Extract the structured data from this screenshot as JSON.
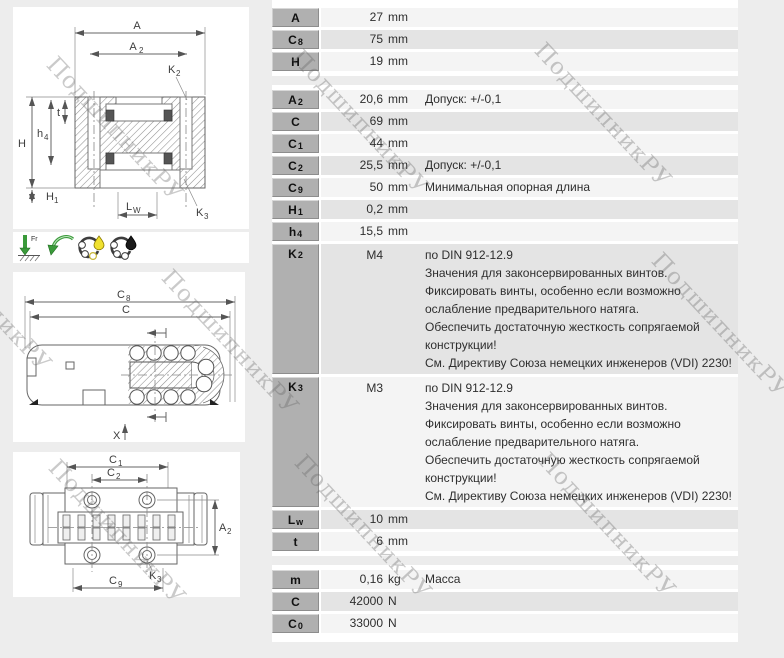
{
  "watermark": {
    "text": "ПодшипникРУ",
    "positions": [
      {
        "x": 60,
        "y": 52
      },
      {
        "x": 305,
        "y": 45
      },
      {
        "x": 548,
        "y": 38
      },
      {
        "x": -72,
        "y": 222
      },
      {
        "x": 175,
        "y": 265
      },
      {
        "x": 665,
        "y": 248
      },
      {
        "x": 62,
        "y": 455
      },
      {
        "x": 308,
        "y": 450
      },
      {
        "x": 552,
        "y": 448
      }
    ]
  },
  "colors": {
    "page_bg": "#ededed",
    "label_cell": "#b0b0b0",
    "row_light": "#f4f4f4",
    "row_dark": "#e4e4e4",
    "accent_green": "#3a9a3a",
    "drop_yellow": "#f0e130",
    "drop_black": "#1a1a1a"
  },
  "drawings": {
    "section_view": {
      "dim_A": "A",
      "dim_A2_base": "A",
      "dim_A2_sub": "2",
      "dim_K2_base": "K",
      "dim_K2_sub": "2",
      "dim_H": "H",
      "dim_h4_base": "h",
      "dim_h4_sub": "4",
      "dim_t": "t",
      "dim_H1_base": "H",
      "dim_H1_sub": "1",
      "dim_Lw_base": "L",
      "dim_Lw_sub": "W",
      "dim_K3_base": "K",
      "dim_K3_sub": "3"
    },
    "side_view": {
      "dim_C8_base": "C",
      "dim_C8_sub": "8",
      "dim_C": "C",
      "dim_X": "X"
    },
    "bottom_view": {
      "dim_C1_base": "C",
      "dim_C1_sub": "1",
      "dim_C2_base": "C",
      "dim_C2_sub": "2",
      "dim_A2_base": "A",
      "dim_A2_sub": "2",
      "dim_K3_base": "K",
      "dim_K3_sub": "3",
      "dim_C9_base": "C",
      "dim_C9_sub": "9"
    },
    "icons": {
      "radial_load_label": "Fr"
    }
  },
  "table": {
    "sections": [
      {
        "rows": [
          {
            "label": {
              "base": "A"
            },
            "value": "27",
            "unit": "mm",
            "desc": ""
          },
          {
            "label": {
              "base": "C",
              "sub": "8"
            },
            "value": "75",
            "unit": "mm",
            "desc": ""
          },
          {
            "label": {
              "base": "H"
            },
            "value": "19",
            "unit": "mm",
            "desc": ""
          }
        ]
      },
      {
        "rows": [
          {
            "label": {
              "base": "A",
              "sub": "2"
            },
            "value": "20,6",
            "unit": "mm",
            "desc": "Допуск: +/-0,1"
          },
          {
            "label": {
              "base": "C"
            },
            "value": "69",
            "unit": "mm",
            "desc": ""
          },
          {
            "label": {
              "base": "C",
              "sub": "1"
            },
            "value": "44",
            "unit": "mm",
            "desc": ""
          },
          {
            "label": {
              "base": "C",
              "sub": "2"
            },
            "value": "25,5",
            "unit": "mm",
            "desc": "Допуск: +/-0,1"
          },
          {
            "label": {
              "base": "C",
              "sub": "9"
            },
            "value": "50",
            "unit": "mm",
            "desc": "Минимальная опорная длина"
          },
          {
            "label": {
              "base": "H",
              "sub": "1"
            },
            "value": "0,2",
            "unit": "mm",
            "desc": ""
          },
          {
            "label": {
              "base": "h",
              "sub": "4"
            },
            "value": "15,5",
            "unit": "mm",
            "desc": ""
          },
          {
            "label": {
              "base": "K",
              "sub": "2"
            },
            "value": "M4",
            "unit": "",
            "desc_lines": [
              "по DIN 912-12.9",
              "Значения для законсервированных винтов.",
              "Фиксировать винты, особенно если возможно",
              "ослабление предварительного натяга.",
              "Обеспечить достаточную жесткость сопрягаемой",
              "конструкции!",
              "См. Директиву Союза немецких инженеров (VDI) 2230!"
            ]
          },
          {
            "label": {
              "base": "K",
              "sub": "3"
            },
            "value": "M3",
            "unit": "",
            "desc_lines": [
              "по DIN 912-12.9",
              "Значения для законсервированных винтов.",
              "Фиксировать винты, особенно если возможно",
              "ослабление предварительного натяга.",
              "Обеспечить достаточную жесткость сопрягаемой",
              "конструкции!",
              "См. Директиву Союза немецких инженеров (VDI) 2230!"
            ]
          },
          {
            "label": {
              "base": "L",
              "sub": "w"
            },
            "value": "10",
            "unit": "mm",
            "desc": ""
          },
          {
            "label": {
              "base": "t"
            },
            "value": "6",
            "unit": "mm",
            "desc": ""
          }
        ]
      },
      {
        "rows": [
          {
            "label": {
              "base": "m"
            },
            "value": "0,16",
            "unit": "kg",
            "desc": "Масса"
          },
          {
            "label": {
              "base": "C"
            },
            "value": "42000",
            "unit": "N",
            "desc": ""
          },
          {
            "label": {
              "base": "C",
              "sub": "0"
            },
            "value": "33000",
            "unit": "N",
            "desc": ""
          }
        ]
      }
    ]
  }
}
